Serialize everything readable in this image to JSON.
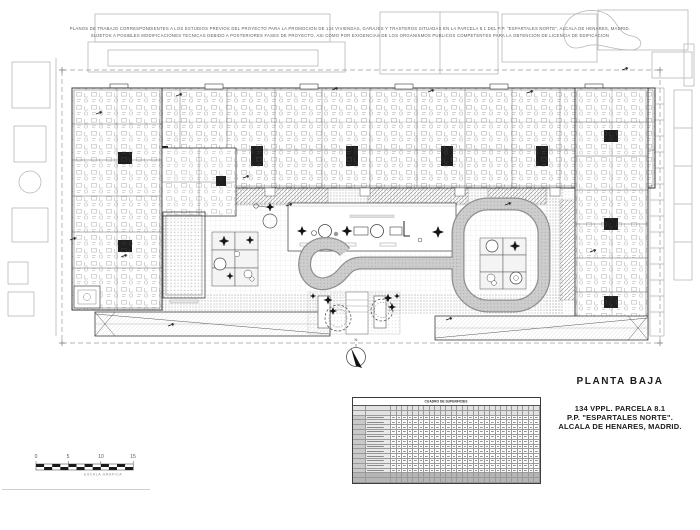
{
  "sheet": {
    "disclaimer_line1": "PLANOS DE TRABAJO CORRESPONDIENTES A LOS ESTUDIOS PREVIOS DEL PROYECTO PARA LA PROMOCION DE 134 VIVIENDAS, GARAJES Y TRASTEROS SITUADAS EN LA PARCELA 8.1 DEL  P.P. \"ESPARTALES NORTE\", ALCALA DE HENARES, MADRID.",
    "disclaimer_line2": "SUJETOS A POSIBLES MODIFICACIONES TECNICAS DEBIDO A POSTERIORES FASES DE PROYECTO, ASI COMO POR EXIGENCIAS DE LOS ORGANISMOS PUBLICOS COMPETENTES PARA LA OBTENCION DE LICENCIA DE EDIFICACION"
  },
  "title_block": {
    "drawing_title": "PLANTA BAJA",
    "project_line1": "134 VPPL. PARCELA 8.1",
    "project_line2": "P.P. \"ESPARTALES NORTE\".",
    "project_line3": "ALCALA DE HENARES, MADRID."
  },
  "scale_bar": {
    "ticks": [
      "0",
      "5",
      "10",
      "15"
    ],
    "caption": "ESCALA GRAFICA"
  },
  "north_arrow": {
    "label": "N"
  },
  "summary_table": {
    "title": "CUADRO DE SUPERFICIES",
    "header_rows": 2,
    "body_rows": 12,
    "footer_rows": 2,
    "data_columns": 27
  },
  "colors": {
    "wall_line": "#3a3a3a",
    "context_line": "#b8b8b8",
    "hatch_gray": "#8d8d8d",
    "dark_fill": "#1a1a1a",
    "paper": "#ffffff"
  }
}
